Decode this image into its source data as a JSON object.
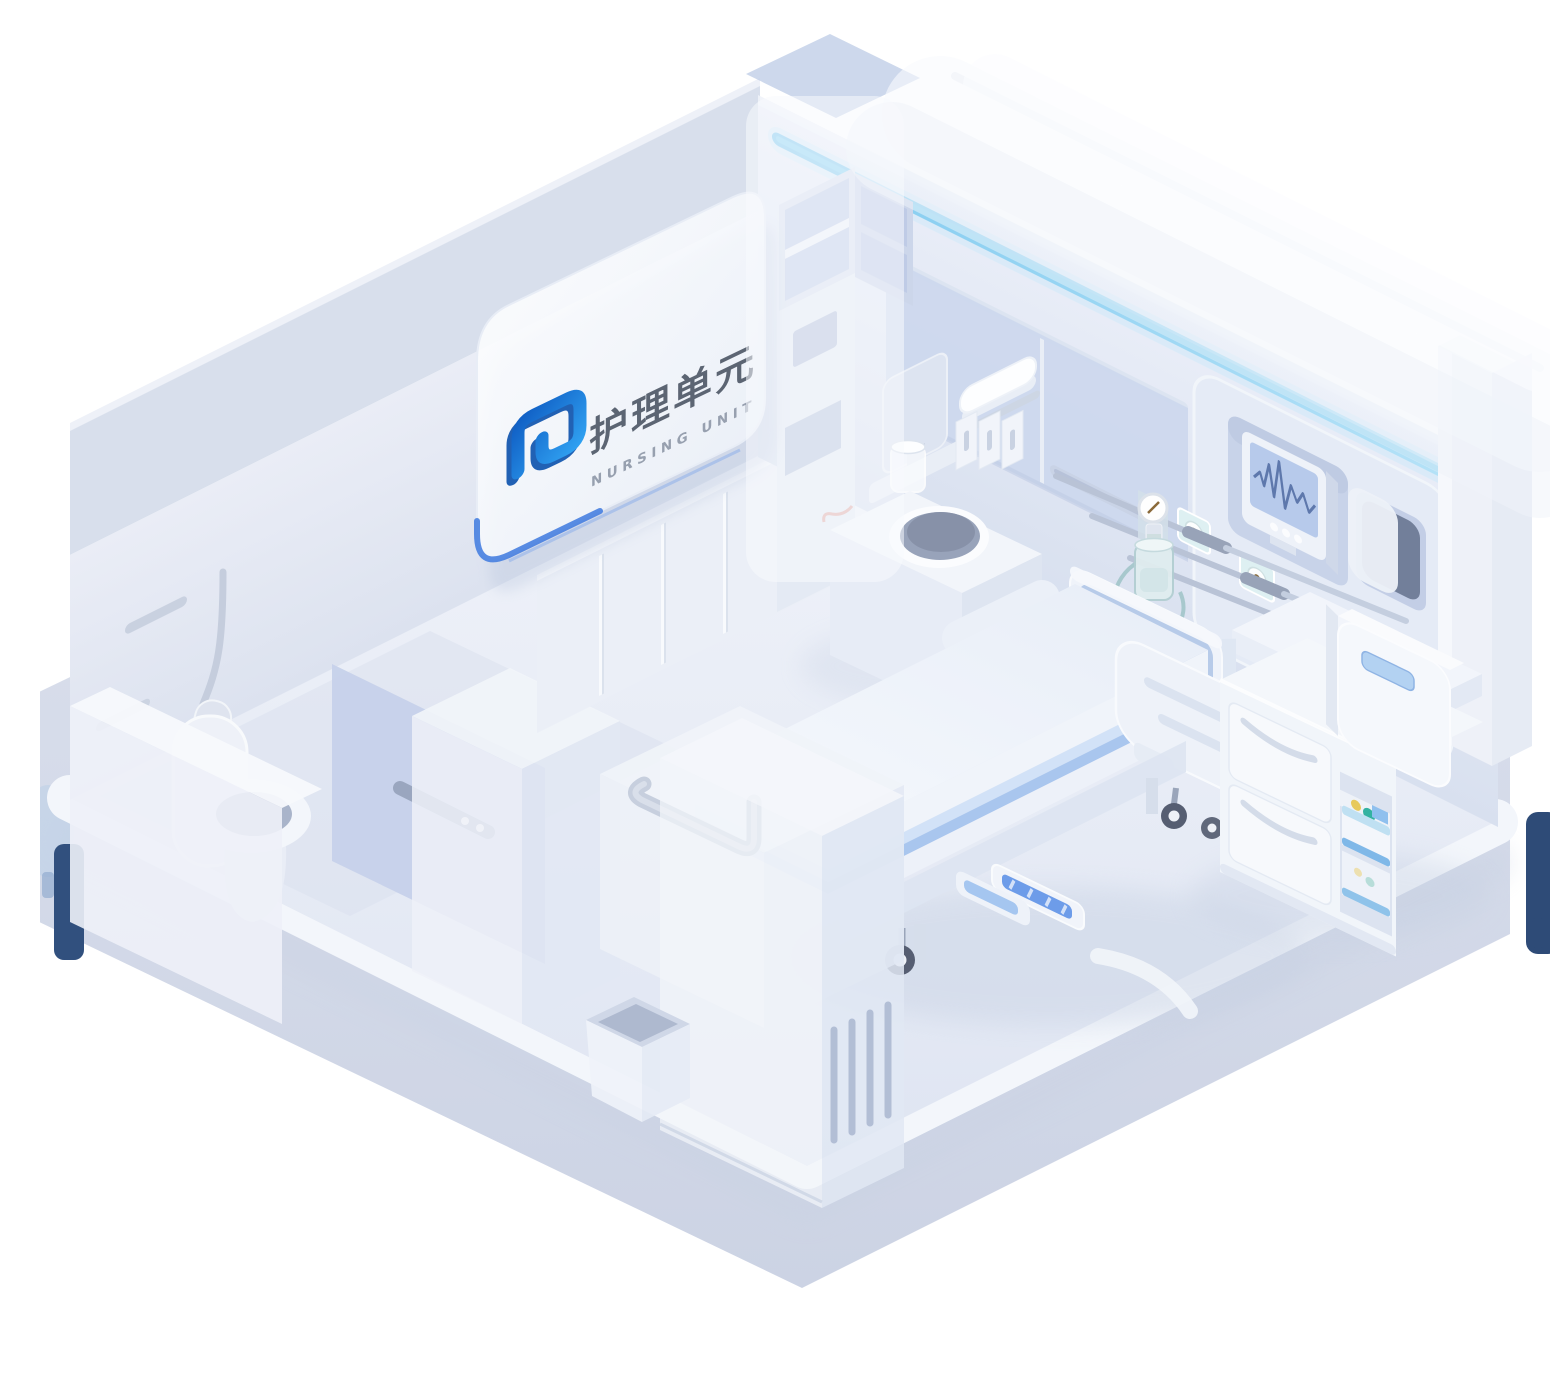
{
  "meta": {
    "title": "护理单元 Nursing Unit isometric room illustration"
  },
  "sign": {
    "title_zh": "护理单元",
    "subtitle_en": "NURSING UNIT"
  },
  "palette": {
    "background": "#ffffff",
    "logo_blue_dark": "#0f54ae",
    "logo_blue": "#2f9ff0",
    "light_strip_cyan": "#7ac8f2",
    "navy_accent": "#2e4b77",
    "wall": "#e6ebf6",
    "wall_panel_blue": "#ccd7ed",
    "floor": "#e9edf7",
    "ground": "#d4dbe9",
    "curb_white": "#f3f6fb",
    "headboard_blue": "#b7cbe9",
    "mattress_stripe_blue": "#a9c6ee",
    "monitor_screen": "#b7caeb",
    "ecg_wave": "#5e78ac",
    "oxygen_teal": "#a3c6ca",
    "device_teal_button": "#32b2a1",
    "device_yellow_button": "#e7c95c",
    "partition_blue": "#c6d1ea"
  },
  "scene": {
    "objects": [
      "glass-sign",
      "logo-mark",
      "curtain",
      "wall-light-strip",
      "overhead-cabinets",
      "corner-shelf",
      "patient-monitor",
      "supply-niche",
      "paper-dispenser",
      "power-outlets",
      "oxygen-flowmeter",
      "humidifier-bottle",
      "wall-cables",
      "hospital-bed",
      "headboard",
      "side-rail",
      "foot-pedals",
      "casters",
      "bedside-cabinet",
      "mini-fridge",
      "infusion-device",
      "sink",
      "cup-dispenser",
      "cup",
      "towel",
      "bottles",
      "wardrobe-column",
      "grab-bar-cabinet",
      "trash-bin",
      "toilet",
      "shower",
      "bath-partition",
      "floor-platform",
      "navy-accent-left",
      "navy-accent-right"
    ]
  }
}
